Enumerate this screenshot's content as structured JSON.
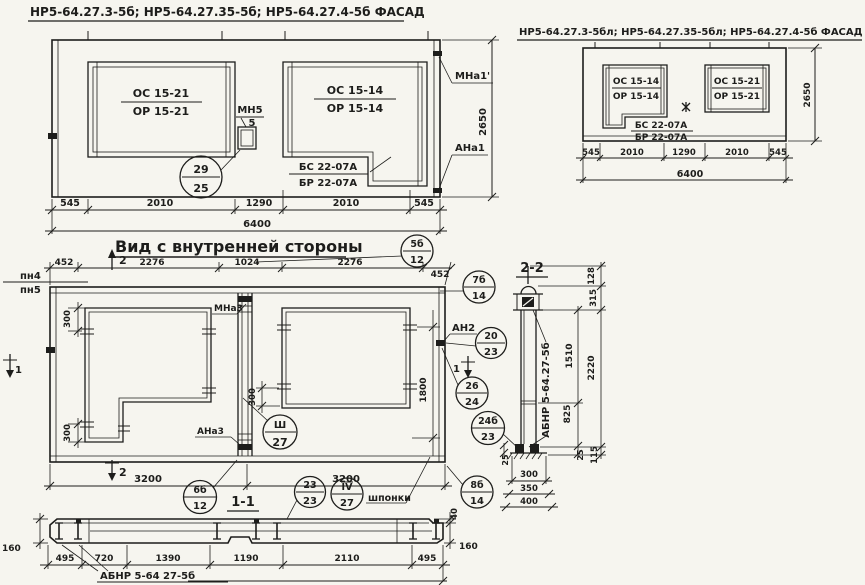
{
  "colors": {
    "paper": "#f6f5ef",
    "ink": "#1d1d1b"
  },
  "facade_main": {
    "title": "НР5-64.27.3-5б; НР5-64.27.35-5б; НР5-64.27.4-5б ФАСАД",
    "window_left": {
      "top": "ОС 15-21",
      "bottom": "ОР 15-21"
    },
    "window_right": {
      "top": "ОС 15-14",
      "bottom": "ОР 15-14"
    },
    "mullion": {
      "top": "МН5",
      "bottom": "5"
    },
    "beam": {
      "top": "БС 22-07А",
      "bottom": "БР 22-07А"
    },
    "node_circle": {
      "top": "29",
      "bottom": "25"
    },
    "anchor_top": "МНа1'",
    "anchor_bottom": "АНа1",
    "dim_height": "2650",
    "dims": [
      "545",
      "2010",
      "1290",
      "2010",
      "545"
    ],
    "dim_total": "6400"
  },
  "facade_mirror": {
    "title": "НР5-64.27.3-5бл; НР5-64.27.35-5бл; НР5-64.27.4-5б ФАСАД",
    "window_left": {
      "top": "ОС 15-14",
      "bottom": "ОР 15-14"
    },
    "window_right": {
      "top": "ОС 15-21",
      "bottom": "ОР 15-21"
    },
    "beam": {
      "top": "БС 22-07А",
      "bottom": "БР 22-07А"
    },
    "dim_height": "2650",
    "dims": [
      "545",
      "2010",
      "1290",
      "2010",
      "545"
    ],
    "dim_total": "6400"
  },
  "inner_view": {
    "title": "Вид с внутренней стороны",
    "rail_top": "пн4",
    "rail_bottom": "пн5",
    "dims_top": [
      "452",
      "2276",
      "1024",
      "2276",
      "452"
    ],
    "dim_300_top": "300",
    "dim_300_bottom": "300",
    "dim_300_mid": "300",
    "dim_1800": "1800",
    "dims_bottom": [
      "3200",
      "3200"
    ],
    "label_mna3": "МНа3",
    "label_ana3": "АНа3",
    "label_an2": "АН2",
    "label_shponki": "шпонки",
    "cut_marker_2": "2",
    "cut_marker_1": "1",
    "circle_5b": {
      "top": "5б",
      "bottom": "12"
    },
    "circle_7b": {
      "top": "7б",
      "bottom": "14"
    },
    "circle_20": {
      "top": "20",
      "bottom": "23"
    },
    "circle_26": {
      "top": "26",
      "bottom": "24"
    },
    "circle_24b": {
      "top": "24б",
      "bottom": "23"
    },
    "circle_sh": {
      "top": "Ш",
      "bottom": "27"
    },
    "circle_6b": {
      "top": "6б",
      "bottom": "12"
    },
    "circle_23": {
      "top": "23",
      "bottom": "23"
    },
    "circle_iv": {
      "top": "IV",
      "bottom": "27"
    },
    "circle_8b": {
      "top": "8б",
      "bottom": "14"
    }
  },
  "section_2_2": {
    "title": "2-2",
    "label": "АБНР 5-64.27-5б",
    "dim_128": "128",
    "dim_315": "315",
    "dim_2220": "2220",
    "dim_1510": "1510",
    "dim_825": "825",
    "dim_25_right": "25",
    "dim_25_left": "25",
    "dim_115": "115",
    "dims_bottom": [
      "300",
      "350",
      "400"
    ]
  },
  "section_1_1": {
    "title": "1-1",
    "label": "АБНР 5-64 27-5б",
    "dim_160_left": "160",
    "dim_160_right": "160",
    "dim_40": "40",
    "dims": [
      "495",
      "720",
      "1390",
      "1190",
      "2110",
      "495"
    ]
  }
}
